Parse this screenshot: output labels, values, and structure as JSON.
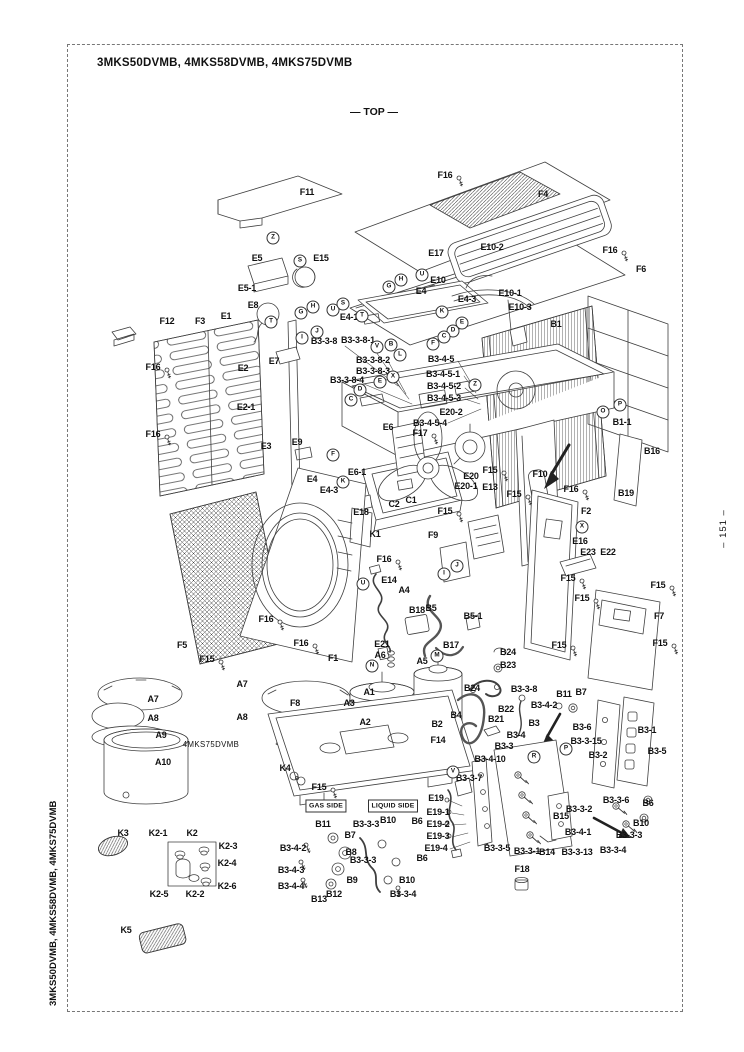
{
  "page": {
    "title": "3MKS50DVMB, 4MKS58DVMB, 4MKS75DVMB",
    "orientation_label": "— TOP —",
    "side_title": "3MKS50DVMB, 4MKS58DVMB, 4MKS75DVMB",
    "page_number": "– 151 –"
  },
  "diagram": {
    "colors": {
      "line": "#3f3f3f",
      "text": "#111111",
      "background": "#ffffff"
    },
    "part_labels": [
      {
        "t": "F11",
        "x": 307,
        "y": 192
      },
      {
        "t": "F16",
        "x": 445,
        "y": 175
      },
      {
        "t": "F4",
        "x": 543,
        "y": 194
      },
      {
        "t": "F16",
        "x": 610,
        "y": 250
      },
      {
        "t": "F6",
        "x": 641,
        "y": 269
      },
      {
        "t": "E10-2",
        "x": 492,
        "y": 247
      },
      {
        "t": "E17",
        "x": 436,
        "y": 253
      },
      {
        "t": "E5",
        "x": 257,
        "y": 258
      },
      {
        "t": "E15",
        "x": 321,
        "y": 258
      },
      {
        "t": "E5-1",
        "x": 247,
        "y": 288
      },
      {
        "t": "E8",
        "x": 253,
        "y": 305
      },
      {
        "t": "E10",
        "x": 438,
        "y": 280
      },
      {
        "t": "E4",
        "x": 421,
        "y": 291
      },
      {
        "t": "E4-3",
        "x": 467,
        "y": 299
      },
      {
        "t": "E10-1",
        "x": 510,
        "y": 293
      },
      {
        "t": "E10-3",
        "x": 520,
        "y": 307
      },
      {
        "t": "E4-1",
        "x": 349,
        "y": 317
      },
      {
        "t": "B1",
        "x": 556,
        "y": 324
      },
      {
        "t": "E1",
        "x": 226,
        "y": 316
      },
      {
        "t": "F3",
        "x": 200,
        "y": 321
      },
      {
        "t": "F12",
        "x": 167,
        "y": 321
      },
      {
        "t": "F16",
        "x": 153,
        "y": 367
      },
      {
        "t": "E2",
        "x": 243,
        "y": 368
      },
      {
        "t": "E7",
        "x": 274,
        "y": 361
      },
      {
        "t": "B3-3-8",
        "x": 324,
        "y": 341
      },
      {
        "t": "B3-3-8-1",
        "x": 358,
        "y": 340
      },
      {
        "t": "B3-3-8-2",
        "x": 373,
        "y": 360
      },
      {
        "t": "B3-3-8-3",
        "x": 373,
        "y": 371
      },
      {
        "t": "B3-3-8-4",
        "x": 347,
        "y": 380
      },
      {
        "t": "E2-1",
        "x": 246,
        "y": 407
      },
      {
        "t": "F16",
        "x": 153,
        "y": 434
      },
      {
        "t": "E3",
        "x": 266,
        "y": 446
      },
      {
        "t": "E9",
        "x": 297,
        "y": 442
      },
      {
        "t": "E6",
        "x": 388,
        "y": 427
      },
      {
        "t": "B3-4-5",
        "x": 441,
        "y": 359
      },
      {
        "t": "B3-4-5-1",
        "x": 443,
        "y": 374
      },
      {
        "t": "B3-4-5-2",
        "x": 444,
        "y": 386
      },
      {
        "t": "B3-4-5-3",
        "x": 444,
        "y": 398
      },
      {
        "t": "E20-2",
        "x": 451,
        "y": 412
      },
      {
        "t": "B3-4-5-4",
        "x": 430,
        "y": 423
      },
      {
        "t": "F17",
        "x": 420,
        "y": 433
      },
      {
        "t": "E6-1",
        "x": 357,
        "y": 472
      },
      {
        "t": "E4",
        "x": 312,
        "y": 479
      },
      {
        "t": "E4-3",
        "x": 329,
        "y": 490
      },
      {
        "t": "E18",
        "x": 361,
        "y": 512
      },
      {
        "t": "C2",
        "x": 394,
        "y": 504
      },
      {
        "t": "C1",
        "x": 411,
        "y": 500
      },
      {
        "t": "F15",
        "x": 490,
        "y": 470
      },
      {
        "t": "E20",
        "x": 471,
        "y": 476
      },
      {
        "t": "E20-1",
        "x": 466,
        "y": 486
      },
      {
        "t": "E13",
        "x": 490,
        "y": 487
      },
      {
        "t": "F15",
        "x": 514,
        "y": 494
      },
      {
        "t": "F10",
        "x": 540,
        "y": 474
      },
      {
        "t": "F15",
        "x": 445,
        "y": 511
      },
      {
        "t": "F9",
        "x": 433,
        "y": 535
      },
      {
        "t": "F16",
        "x": 571,
        "y": 489
      },
      {
        "t": "B1-1",
        "x": 622,
        "y": 422
      },
      {
        "t": "B16",
        "x": 652,
        "y": 451
      },
      {
        "t": "B19",
        "x": 626,
        "y": 493
      },
      {
        "t": "F2",
        "x": 586,
        "y": 511
      },
      {
        "t": "E16",
        "x": 580,
        "y": 541
      },
      {
        "t": "E23",
        "x": 588,
        "y": 552
      },
      {
        "t": "E22",
        "x": 608,
        "y": 552
      },
      {
        "t": "F15",
        "x": 568,
        "y": 578
      },
      {
        "t": "F15",
        "x": 582,
        "y": 598
      },
      {
        "t": "F15",
        "x": 658,
        "y": 585
      },
      {
        "t": "F7",
        "x": 659,
        "y": 616
      },
      {
        "t": "F15",
        "x": 660,
        "y": 643
      },
      {
        "t": "F15",
        "x": 559,
        "y": 645
      },
      {
        "t": "K1",
        "x": 375,
        "y": 534
      },
      {
        "t": "F16",
        "x": 384,
        "y": 559
      },
      {
        "t": "E14",
        "x": 389,
        "y": 580
      },
      {
        "t": "A4",
        "x": 404,
        "y": 590
      },
      {
        "t": "B18",
        "x": 417,
        "y": 610
      },
      {
        "t": "B5",
        "x": 431,
        "y": 608
      },
      {
        "t": "B5-1",
        "x": 473,
        "y": 616
      },
      {
        "t": "E21",
        "x": 382,
        "y": 644
      },
      {
        "t": "A6",
        "x": 380,
        "y": 655
      },
      {
        "t": "B17",
        "x": 451,
        "y": 645
      },
      {
        "t": "A5",
        "x": 422,
        "y": 661
      },
      {
        "t": "B24",
        "x": 508,
        "y": 652
      },
      {
        "t": "B23",
        "x": 508,
        "y": 665
      },
      {
        "t": "F5",
        "x": 182,
        "y": 645
      },
      {
        "t": "F15",
        "x": 207,
        "y": 659
      },
      {
        "t": "F16",
        "x": 266,
        "y": 619
      },
      {
        "t": "F16",
        "x": 301,
        "y": 643
      },
      {
        "t": "F1",
        "x": 333,
        "y": 658
      },
      {
        "t": "A7",
        "x": 153,
        "y": 699
      },
      {
        "t": "A8",
        "x": 153,
        "y": 718
      },
      {
        "t": "A9",
        "x": 161,
        "y": 735
      },
      {
        "t": "A10",
        "x": 163,
        "y": 762
      },
      {
        "t": "A7",
        "x": 242,
        "y": 684
      },
      {
        "t": "A8",
        "x": 242,
        "y": 717
      },
      {
        "t": "4MKS75DVMB",
        "x": 211,
        "y": 745,
        "k": "note"
      },
      {
        "t": "F8",
        "x": 295,
        "y": 703
      },
      {
        "t": "K4",
        "x": 285,
        "y": 768
      },
      {
        "t": "A1",
        "x": 369,
        "y": 692
      },
      {
        "t": "A3",
        "x": 349,
        "y": 703
      },
      {
        "t": "A2",
        "x": 365,
        "y": 722
      },
      {
        "t": "B2",
        "x": 437,
        "y": 724
      },
      {
        "t": "F14",
        "x": 438,
        "y": 740
      },
      {
        "t": "B4",
        "x": 456,
        "y": 715
      },
      {
        "t": "F15",
        "x": 319,
        "y": 787
      },
      {
        "t": "GAS SIDE",
        "x": 326,
        "y": 806,
        "k": "boxed"
      },
      {
        "t": "LIQUID SIDE",
        "x": 393,
        "y": 806,
        "k": "boxed"
      },
      {
        "t": "B11",
        "x": 323,
        "y": 824
      },
      {
        "t": "B7",
        "x": 350,
        "y": 835
      },
      {
        "t": "B3-4-2",
        "x": 293,
        "y": 848
      },
      {
        "t": "B8",
        "x": 351,
        "y": 852
      },
      {
        "t": "B3-4-3",
        "x": 291,
        "y": 870
      },
      {
        "t": "B3-4-4",
        "x": 291,
        "y": 886
      },
      {
        "t": "B9",
        "x": 352,
        "y": 880
      },
      {
        "t": "B12",
        "x": 334,
        "y": 894
      },
      {
        "t": "B13",
        "x": 319,
        "y": 899
      },
      {
        "t": "B3-3-3",
        "x": 366,
        "y": 824
      },
      {
        "t": "B10",
        "x": 388,
        "y": 820
      },
      {
        "t": "B6",
        "x": 417,
        "y": 821
      },
      {
        "t": "B3-3-3",
        "x": 363,
        "y": 860
      },
      {
        "t": "B6",
        "x": 422,
        "y": 858
      },
      {
        "t": "B10",
        "x": 407,
        "y": 880
      },
      {
        "t": "B3-3-4",
        "x": 403,
        "y": 894
      },
      {
        "t": "E19",
        "x": 436,
        "y": 798
      },
      {
        "t": "E19-1",
        "x": 438,
        "y": 812
      },
      {
        "t": "E19-2",
        "x": 438,
        "y": 824
      },
      {
        "t": "E19-3",
        "x": 438,
        "y": 836
      },
      {
        "t": "E19-4",
        "x": 436,
        "y": 848
      },
      {
        "t": "B24",
        "x": 472,
        "y": 688
      },
      {
        "t": "B3-3-8",
        "x": 524,
        "y": 689
      },
      {
        "t": "B11",
        "x": 564,
        "y": 694
      },
      {
        "t": "B7",
        "x": 581,
        "y": 692
      },
      {
        "t": "B22",
        "x": 506,
        "y": 709
      },
      {
        "t": "B3-4-2",
        "x": 544,
        "y": 705
      },
      {
        "t": "B21",
        "x": 496,
        "y": 719
      },
      {
        "t": "B3",
        "x": 534,
        "y": 723
      },
      {
        "t": "B3-6",
        "x": 582,
        "y": 727
      },
      {
        "t": "B3-4",
        "x": 516,
        "y": 735
      },
      {
        "t": "B3-3",
        "x": 504,
        "y": 746
      },
      {
        "t": "B3-3-15",
        "x": 586,
        "y": 741
      },
      {
        "t": "B3-2",
        "x": 598,
        "y": 755
      },
      {
        "t": "B3-4-10",
        "x": 490,
        "y": 759
      },
      {
        "t": "B3-3-7",
        "x": 469,
        "y": 778
      },
      {
        "t": "B3-1",
        "x": 647,
        "y": 730
      },
      {
        "t": "B3-5",
        "x": 657,
        "y": 751
      },
      {
        "t": "B3-3-6",
        "x": 616,
        "y": 800
      },
      {
        "t": "B6",
        "x": 648,
        "y": 803
      },
      {
        "t": "B3-3-2",
        "x": 579,
        "y": 809
      },
      {
        "t": "B15",
        "x": 561,
        "y": 816
      },
      {
        "t": "B10",
        "x": 641,
        "y": 823
      },
      {
        "t": "B3-4-1",
        "x": 578,
        "y": 832
      },
      {
        "t": "B3-3-3",
        "x": 629,
        "y": 835
      },
      {
        "t": "B14",
        "x": 547,
        "y": 852
      },
      {
        "t": "B3-3-13",
        "x": 577,
        "y": 852
      },
      {
        "t": "B3-3-4",
        "x": 613,
        "y": 850
      },
      {
        "t": "B3-3-5",
        "x": 497,
        "y": 848
      },
      {
        "t": "B3-3-1",
        "x": 527,
        "y": 851
      },
      {
        "t": "F18",
        "x": 522,
        "y": 869
      },
      {
        "t": "K3",
        "x": 123,
        "y": 833
      },
      {
        "t": "K2-1",
        "x": 158,
        "y": 833
      },
      {
        "t": "K2",
        "x": 192,
        "y": 833
      },
      {
        "t": "K2-3",
        "x": 228,
        "y": 846
      },
      {
        "t": "K2-4",
        "x": 227,
        "y": 863
      },
      {
        "t": "K2-6",
        "x": 227,
        "y": 886
      },
      {
        "t": "K2-5",
        "x": 159,
        "y": 894
      },
      {
        "t": "K2-2",
        "x": 195,
        "y": 894
      },
      {
        "t": "K5",
        "x": 126,
        "y": 930
      }
    ],
    "connector_callouts": [
      {
        "l": "Z",
        "x": 273,
        "y": 238
      },
      {
        "l": "S",
        "x": 300,
        "y": 261
      },
      {
        "l": "T",
        "x": 271,
        "y": 322
      },
      {
        "l": "G",
        "x": 301,
        "y": 313
      },
      {
        "l": "H",
        "x": 313,
        "y": 307
      },
      {
        "l": "U",
        "x": 333,
        "y": 310
      },
      {
        "l": "S",
        "x": 343,
        "y": 304
      },
      {
        "l": "I",
        "x": 302,
        "y": 338
      },
      {
        "l": "J",
        "x": 317,
        "y": 332
      },
      {
        "l": "T",
        "x": 362,
        "y": 316
      },
      {
        "l": "G",
        "x": 389,
        "y": 287
      },
      {
        "l": "H",
        "x": 401,
        "y": 280
      },
      {
        "l": "U",
        "x": 422,
        "y": 275
      },
      {
        "l": "K",
        "x": 442,
        "y": 312
      },
      {
        "l": "E",
        "x": 462,
        "y": 323
      },
      {
        "l": "D",
        "x": 453,
        "y": 331
      },
      {
        "l": "C",
        "x": 444,
        "y": 337
      },
      {
        "l": "F",
        "x": 433,
        "y": 344
      },
      {
        "l": "B",
        "x": 391,
        "y": 345
      },
      {
        "l": "L",
        "x": 400,
        "y": 355
      },
      {
        "l": "V",
        "x": 377,
        "y": 347
      },
      {
        "l": "X",
        "x": 393,
        "y": 377
      },
      {
        "l": "E",
        "x": 380,
        "y": 382
      },
      {
        "l": "D",
        "x": 360,
        "y": 390
      },
      {
        "l": "C",
        "x": 351,
        "y": 400
      },
      {
        "l": "F",
        "x": 333,
        "y": 455
      },
      {
        "l": "K",
        "x": 343,
        "y": 482
      },
      {
        "l": "Z",
        "x": 475,
        "y": 385
      },
      {
        "l": "O",
        "x": 603,
        "y": 412
      },
      {
        "l": "P",
        "x": 620,
        "y": 405
      },
      {
        "l": "X",
        "x": 582,
        "y": 527
      },
      {
        "l": "U",
        "x": 363,
        "y": 584
      },
      {
        "l": "I",
        "x": 444,
        "y": 574
      },
      {
        "l": "J",
        "x": 457,
        "y": 566
      },
      {
        "l": "N",
        "x": 372,
        "y": 666
      },
      {
        "l": "M",
        "x": 437,
        "y": 656
      },
      {
        "l": "V",
        "x": 453,
        "y": 772
      },
      {
        "l": "R",
        "x": 534,
        "y": 757
      },
      {
        "l": "P",
        "x": 566,
        "y": 749
      }
    ]
  }
}
